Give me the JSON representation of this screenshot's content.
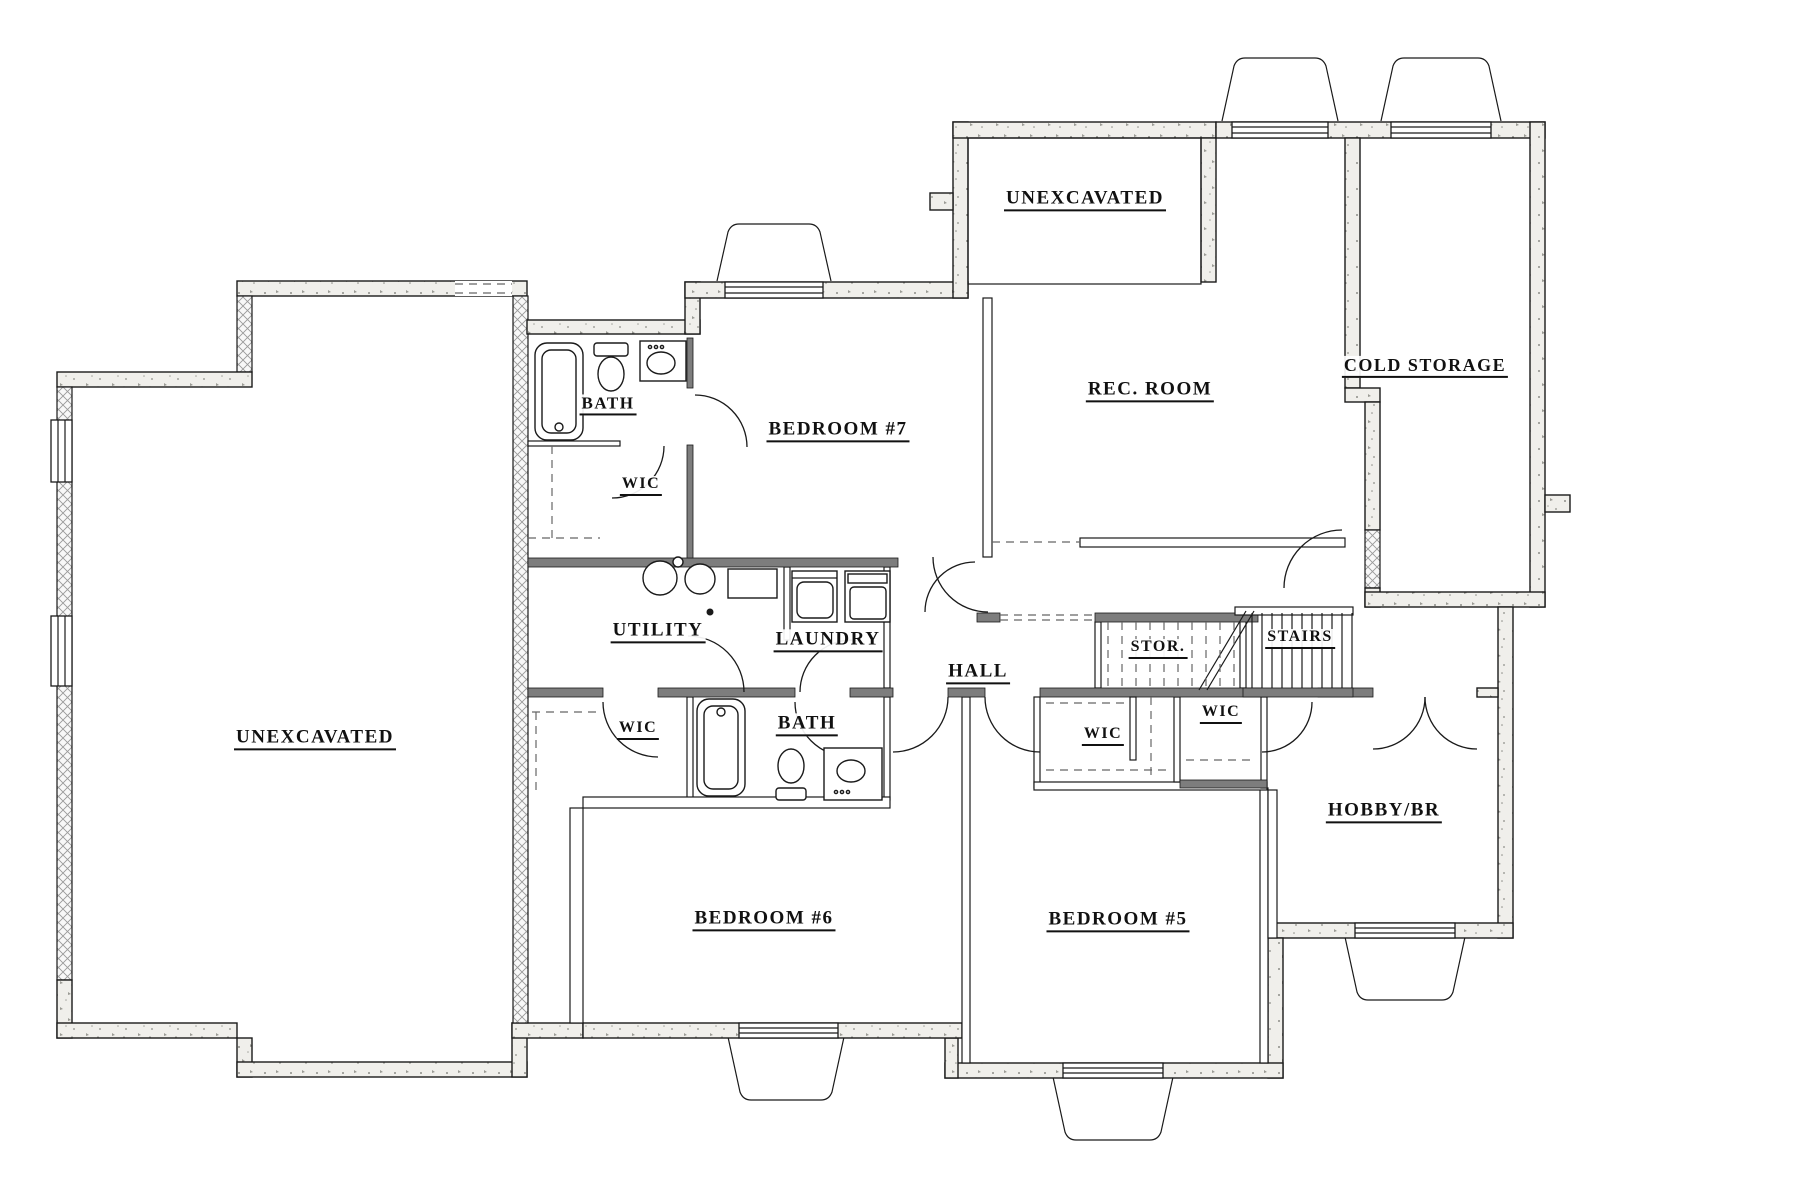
{
  "plan": {
    "title": "Basement Floor Plan",
    "colors": {
      "background": "#ffffff",
      "line": "#1a1a1a",
      "wall_fill": "#f0efeb",
      "dark_wall": "#7d7d7d",
      "foundation_fill": "#f8f8f8"
    },
    "rooms": [
      {
        "id": "unexcavated-left",
        "label": "UNEXCAVATED",
        "x": 315,
        "y": 740,
        "size": 19
      },
      {
        "id": "unexcavated-top",
        "label": "UNEXCAVATED",
        "x": 1085,
        "y": 201,
        "size": 19
      },
      {
        "id": "rec-room",
        "label": "REC. ROOM",
        "x": 1150,
        "y": 392,
        "size": 19
      },
      {
        "id": "cold-storage",
        "label": "COLD STORAGE",
        "x": 1425,
        "y": 368,
        "size": 18
      },
      {
        "id": "bedroom-7",
        "label": "BEDROOM #7",
        "x": 838,
        "y": 432,
        "size": 19
      },
      {
        "id": "bath-upper",
        "label": "BATH",
        "x": 608,
        "y": 406,
        "size": 17
      },
      {
        "id": "wic-upper",
        "label": "WIC",
        "x": 641,
        "y": 487,
        "size": 16
      },
      {
        "id": "utility",
        "label": "UTILITY",
        "x": 658,
        "y": 633,
        "size": 19
      },
      {
        "id": "laundry",
        "label": "LAUNDRY",
        "x": 828,
        "y": 642,
        "size": 19
      },
      {
        "id": "hall",
        "label": "HALL",
        "x": 978,
        "y": 674,
        "size": 19
      },
      {
        "id": "stor",
        "label": "STOR.",
        "x": 1158,
        "y": 650,
        "size": 16
      },
      {
        "id": "stairs",
        "label": "STAIRS",
        "x": 1300,
        "y": 640,
        "size": 16
      },
      {
        "id": "wic-lower-left",
        "label": "WIC",
        "x": 638,
        "y": 731,
        "size": 16
      },
      {
        "id": "bath-lower",
        "label": "BATH",
        "x": 807,
        "y": 726,
        "size": 19
      },
      {
        "id": "wic-center",
        "label": "WIC",
        "x": 1103,
        "y": 737,
        "size": 16
      },
      {
        "id": "wic-right",
        "label": "WIC",
        "x": 1221,
        "y": 715,
        "size": 16
      },
      {
        "id": "bedroom-6",
        "label": "BEDROOM #6",
        "x": 764,
        "y": 921,
        "size": 19
      },
      {
        "id": "bedroom-5",
        "label": "BEDROOM #5",
        "x": 1118,
        "y": 922,
        "size": 19
      },
      {
        "id": "hobby-br",
        "label": "HOBBY/BR",
        "x": 1384,
        "y": 813,
        "size": 19
      }
    ]
  }
}
